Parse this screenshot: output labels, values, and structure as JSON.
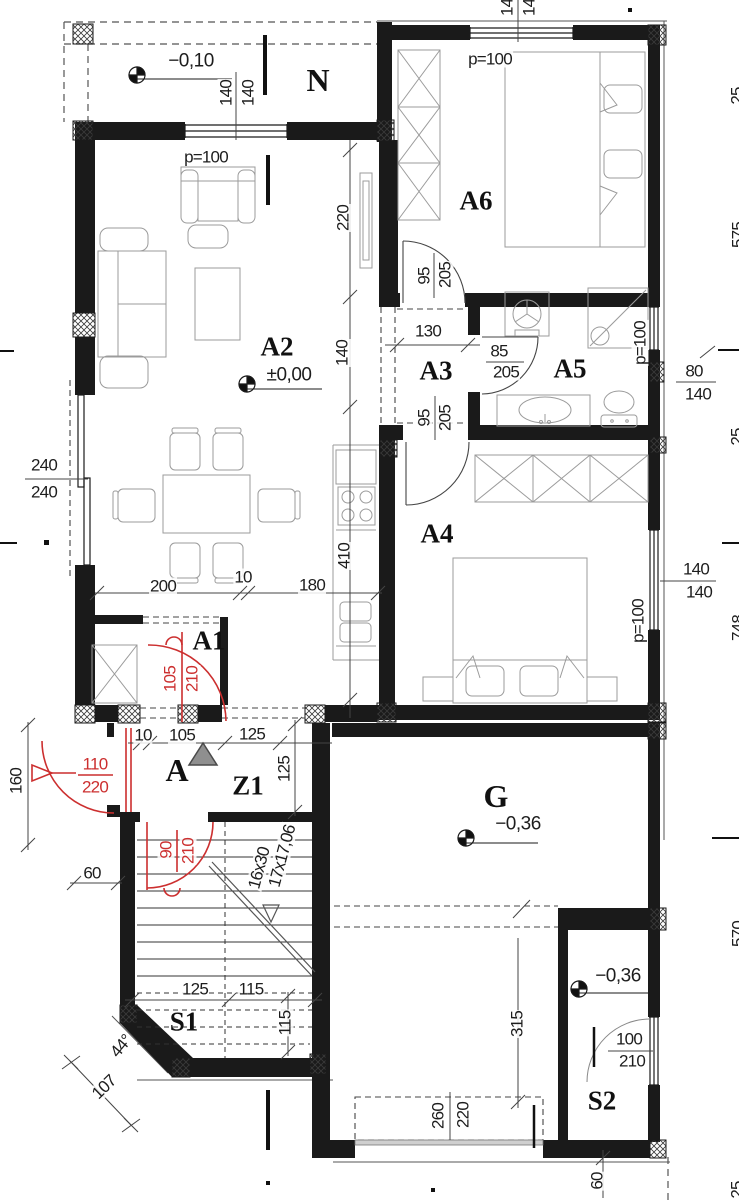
{
  "meta": {
    "drawing_type": "architectural floor plan",
    "units": "cm"
  },
  "palette": {
    "line": "#1a1a1a",
    "furniture": "#999999",
    "door_red": "#cc2f2f",
    "triangle_gray": "#8f8f8f"
  },
  "rooms": [
    "N",
    "A6",
    "A2",
    "A3",
    "A5",
    "A4",
    "A1",
    "A",
    "Z1",
    "G",
    "S1",
    "S2"
  ],
  "elevations": [
    {
      "room": "N",
      "value": "−0,10"
    },
    {
      "room": "A2",
      "value": "±0,00"
    },
    {
      "room": "G",
      "value": "−0,36"
    },
    {
      "room": "S2",
      "value": "−0,36"
    }
  ],
  "annotations": [
    {
      "t": "N",
      "x": 318,
      "y": 80,
      "c": "roomlg"
    },
    {
      "t": "−0,10",
      "x": 191,
      "y": 61,
      "c": "elev"
    },
    {
      "t": "140",
      "x": 226,
      "y": 93,
      "r": -90,
      "c": "dim"
    },
    {
      "t": "140",
      "x": 248,
      "y": 93,
      "r": -90,
      "c": "dim"
    },
    {
      "t": "p=100",
      "x": 206,
      "y": 157,
      "c": "dim"
    },
    {
      "t": "140",
      "x": 507,
      "y": 3,
      "r": -90,
      "c": "dim"
    },
    {
      "t": "140",
      "x": 529,
      "y": 3,
      "r": -90,
      "c": "dim"
    },
    {
      "t": "p=100",
      "x": 490,
      "y": 59,
      "c": "dim"
    },
    {
      "t": "A6",
      "x": 476,
      "y": 201,
      "c": "room"
    },
    {
      "t": "220",
      "x": 343,
      "y": 218,
      "r": -90,
      "c": "dim"
    },
    {
      "t": "95",
      "x": 424,
      "y": 276,
      "r": -90,
      "c": "dim"
    },
    {
      "t": "205",
      "x": 445,
      "y": 275,
      "r": -90,
      "c": "dim"
    },
    {
      "t": "130",
      "x": 428,
      "y": 331,
      "c": "dim"
    },
    {
      "t": "A3",
      "x": 436,
      "y": 371,
      "c": "room"
    },
    {
      "t": "85",
      "x": 499,
      "y": 351,
      "c": "dim"
    },
    {
      "t": "205",
      "x": 506,
      "y": 372,
      "c": "dim"
    },
    {
      "t": "A5",
      "x": 570,
      "y": 369,
      "c": "room"
    },
    {
      "t": "p=100",
      "x": 640,
      "y": 343,
      "r": -90,
      "c": "dim"
    },
    {
      "t": "80",
      "x": 694,
      "y": 371,
      "c": "dim"
    },
    {
      "t": "140",
      "x": 698,
      "y": 394,
      "c": "dim"
    },
    {
      "t": "A2",
      "x": 277,
      "y": 347,
      "c": "room"
    },
    {
      "t": "±0,00",
      "x": 289,
      "y": 375,
      "c": "elev"
    },
    {
      "t": "140",
      "x": 342,
      "y": 353,
      "r": -90,
      "c": "dim"
    },
    {
      "t": "240",
      "x": 44,
      "y": 465,
      "c": "dim"
    },
    {
      "t": "240",
      "x": 44,
      "y": 492,
      "c": "dim"
    },
    {
      "t": "95",
      "x": 424,
      "y": 418,
      "r": -90,
      "c": "dim"
    },
    {
      "t": "205",
      "x": 445,
      "y": 418,
      "r": -90,
      "c": "dim"
    },
    {
      "t": "A4",
      "x": 437,
      "y": 534,
      "c": "room"
    },
    {
      "t": "140",
      "x": 696,
      "y": 569,
      "c": "dim"
    },
    {
      "t": "140",
      "x": 699,
      "y": 592,
      "c": "dim"
    },
    {
      "t": "p=100",
      "x": 638,
      "y": 621,
      "r": -90,
      "c": "dim"
    },
    {
      "t": "410",
      "x": 344,
      "y": 556,
      "r": -90,
      "c": "dim"
    },
    {
      "t": "200",
      "x": 163,
      "y": 586,
      "c": "dim"
    },
    {
      "t": "10",
      "x": 243,
      "y": 577,
      "c": "dim"
    },
    {
      "t": "180",
      "x": 312,
      "y": 585,
      "c": "dim"
    },
    {
      "t": "A1",
      "x": 209,
      "y": 641,
      "c": "room"
    },
    {
      "t": "105",
      "x": 170,
      "y": 679,
      "r": -90,
      "c": "dimred"
    },
    {
      "t": "210",
      "x": 192,
      "y": 679,
      "r": -90,
      "c": "dimred"
    },
    {
      "t": "10",
      "x": 143,
      "y": 735,
      "c": "dim"
    },
    {
      "t": "105",
      "x": 182,
      "y": 735,
      "c": "dim"
    },
    {
      "t": "125",
      "x": 252,
      "y": 734,
      "c": "dim"
    },
    {
      "t": "A",
      "x": 177,
      "y": 770,
      "c": "roomlg"
    },
    {
      "t": "Z1",
      "x": 248,
      "y": 786,
      "c": "room"
    },
    {
      "t": "125",
      "x": 284,
      "y": 769,
      "r": -90,
      "c": "dim"
    },
    {
      "t": "110",
      "x": 95,
      "y": 764,
      "c": "dimred"
    },
    {
      "t": "220",
      "x": 95,
      "y": 787,
      "c": "dimred"
    },
    {
      "t": "160",
      "x": 16,
      "y": 781,
      "r": -90,
      "c": "dim"
    },
    {
      "t": "60",
      "x": 92,
      "y": 873,
      "c": "dim"
    },
    {
      "t": "90",
      "x": 166,
      "y": 850,
      "r": -90,
      "c": "dimred"
    },
    {
      "t": "210",
      "x": 188,
      "y": 851,
      "r": -90,
      "c": "dimred"
    },
    {
      "t": "16x30",
      "x": 259,
      "y": 868,
      "r": -75,
      "c": "dim"
    },
    {
      "t": "17x17,06",
      "x": 282,
      "y": 856,
      "r": -75,
      "c": "dim"
    },
    {
      "t": "G",
      "x": 496,
      "y": 796,
      "c": "roomlg"
    },
    {
      "t": "−0,36",
      "x": 518,
      "y": 824,
      "c": "elev"
    },
    {
      "t": "125",
      "x": 195,
      "y": 989,
      "c": "dim"
    },
    {
      "t": "115",
      "x": 251,
      "y": 989,
      "c": "dim"
    },
    {
      "t": "115",
      "x": 285,
      "y": 1023,
      "r": -90,
      "c": "dim"
    },
    {
      "t": "S1",
      "x": 184,
      "y": 1022,
      "c": "room"
    },
    {
      "t": "44°",
      "x": 121,
      "y": 1046,
      "r": -50,
      "c": "dim"
    },
    {
      "t": "107",
      "x": 104,
      "y": 1087,
      "r": -44,
      "c": "dim"
    },
    {
      "t": "315",
      "x": 517,
      "y": 1024,
      "r": -90,
      "c": "dim"
    },
    {
      "t": "−0,36",
      "x": 618,
      "y": 976,
      "c": "elev"
    },
    {
      "t": "100",
      "x": 629,
      "y": 1039,
      "c": "dim"
    },
    {
      "t": "210",
      "x": 632,
      "y": 1061,
      "c": "dim"
    },
    {
      "t": "S2",
      "x": 602,
      "y": 1101,
      "c": "room"
    },
    {
      "t": "260",
      "x": 438,
      "y": 1116,
      "r": -90,
      "c": "dim"
    },
    {
      "t": "220",
      "x": 463,
      "y": 1115,
      "r": -90,
      "c": "dim"
    },
    {
      "t": "60",
      "x": 597,
      "y": 1181,
      "r": -90,
      "c": "dim"
    },
    {
      "t": "25",
      "x": 737,
      "y": 96,
      "r": -90,
      "c": "dim"
    },
    {
      "t": "575",
      "x": 738,
      "y": 235,
      "r": -90,
      "c": "dim"
    },
    {
      "t": "25",
      "x": 737,
      "y": 437,
      "r": -90,
      "c": "dim"
    },
    {
      "t": "748",
      "x": 738,
      "y": 628,
      "r": -90,
      "c": "dim"
    },
    {
      "t": "570",
      "x": 738,
      "y": 934,
      "r": -90,
      "c": "dim"
    },
    {
      "t": "25",
      "x": 737,
      "y": 1190,
      "r": -90,
      "c": "dim"
    }
  ]
}
